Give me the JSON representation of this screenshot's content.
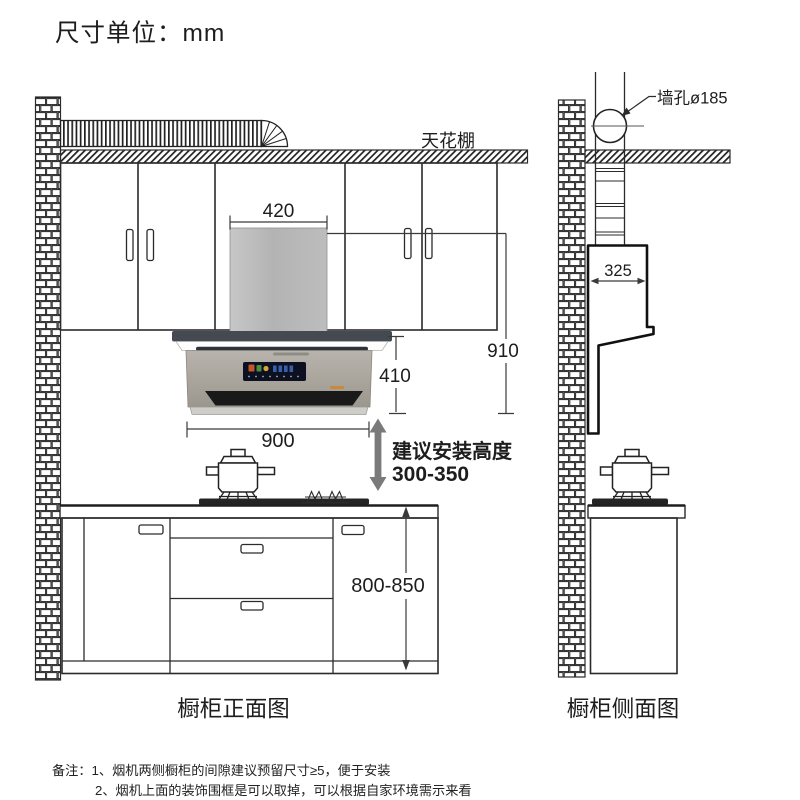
{
  "title": "尺寸单位：mm",
  "front_view": {
    "caption": "橱柜正面图",
    "ceiling_label": "天花棚",
    "dim_chimney_width": "420",
    "dim_total_height": "910",
    "dim_body_height": "410",
    "dim_hood_width": "900",
    "install_height_title": "建议安装高度",
    "install_height_range": "300-350",
    "dim_counter_height": "800-850"
  },
  "side_view": {
    "caption": "橱柜侧面图",
    "wall_hole_label": "墙孔ø185",
    "dim_hood_depth": "325"
  },
  "notes": {
    "line1": "备注：1、烟机两侧橱柜的间隙建议预留尺寸≥5，便于安装",
    "line2": "2、烟机上面的装饰围框是可以取掉，可以根据自家环境需示来看"
  },
  "colors": {
    "line": "#2b2b2b",
    "chimney_grey": "#b9b9b9",
    "hood_body_grey": "#aba69e",
    "hood_base_grey": "#cfcdc8",
    "canopy_dark": "#454a52",
    "vent_dark": "#191919",
    "display_navy": "#0c1020",
    "arrow_grey": "#7a7a7a",
    "cooktop_dark": "#242424"
  }
}
